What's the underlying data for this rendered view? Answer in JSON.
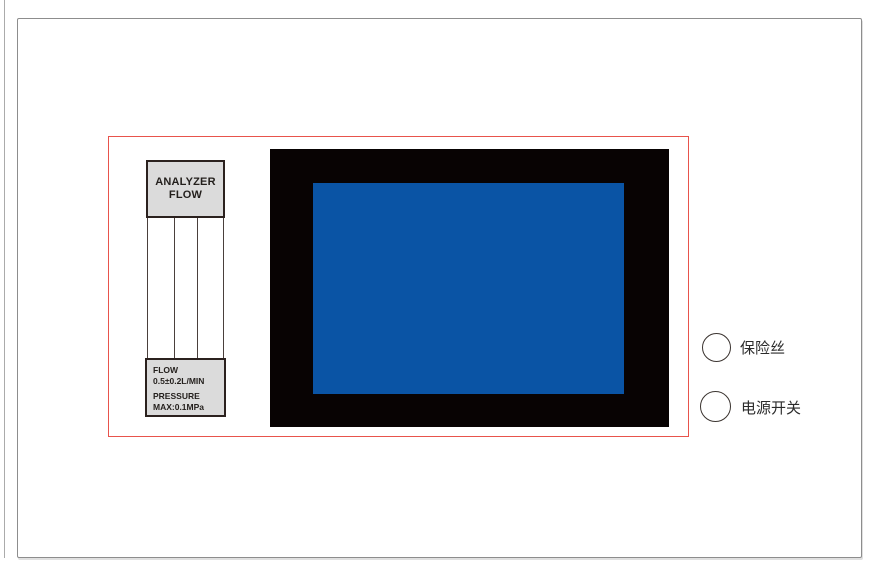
{
  "diagram": {
    "analyzer_label": {
      "line1": "ANALYZER",
      "line2": "FLOW"
    },
    "flow_spec": {
      "line1": "FLOW",
      "line2": "0.5±0.2L/MIN",
      "line3": "PRESSURE",
      "line4": "MAX:0.1MPa"
    },
    "fuse_label": "保险丝",
    "power_switch_label": "电源开关",
    "colors": {
      "screen_blue": "#0a54a5",
      "bezel_black": "#080303",
      "panel_outline_red": "#e8534c",
      "label_fill": "#dbdbdb",
      "label_border": "#2b211e",
      "page_border_gray": "#8d8d8d"
    }
  }
}
